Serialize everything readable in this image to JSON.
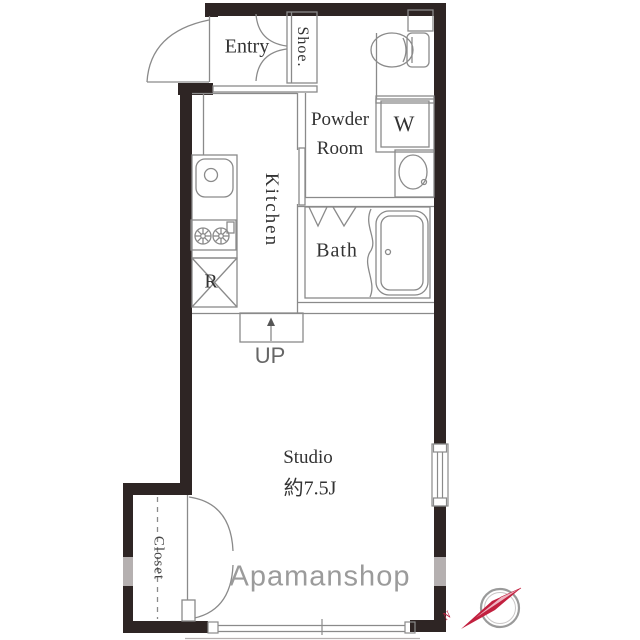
{
  "rooms": {
    "entry": {
      "label": "Entry"
    },
    "shoe": {
      "label": "Shoe."
    },
    "powder_room": {
      "line1": "Powder",
      "line2": "Room"
    },
    "washer": {
      "label": "W"
    },
    "kitchen": {
      "label": "Kitchen"
    },
    "bath": {
      "label": "Bath"
    },
    "refrigerator": {
      "label": "R"
    },
    "step": {
      "label": "UP"
    },
    "studio": {
      "label": "Studio",
      "size": "約7.5J"
    },
    "closet": {
      "label": "Closet"
    }
  },
  "watermark": "Apamanshop",
  "compass": {
    "north_label": "N"
  },
  "colors": {
    "wall": "#2e2524",
    "wall_light_segment": "#b5b0b0",
    "line": "#8a8a8a",
    "text": "#333333",
    "watermark": "#9b9b9b",
    "compass_needle": "#c2203f"
  }
}
